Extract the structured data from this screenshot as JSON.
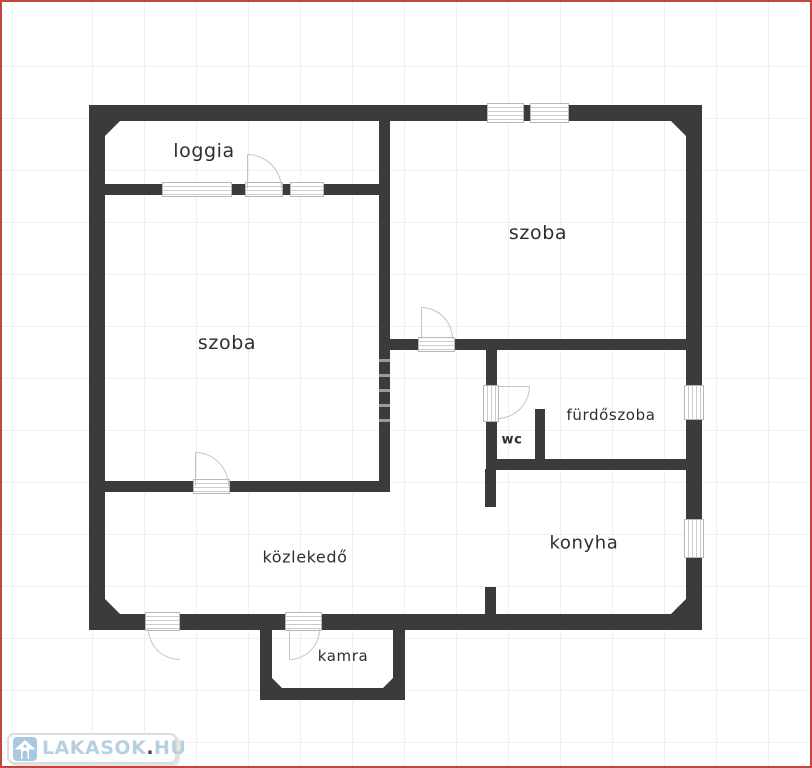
{
  "watermark": {
    "brand_left": "LAKASOK",
    "brand_dot": ".",
    "brand_right": "HU"
  },
  "rooms": [
    {
      "id": "loggia",
      "label": "loggia"
    },
    {
      "id": "szoba-left",
      "label": "szoba"
    },
    {
      "id": "szoba-right",
      "label": "szoba"
    },
    {
      "id": "furdoszoba",
      "label": "fürdőszoba"
    },
    {
      "id": "wc",
      "label": "wc"
    },
    {
      "id": "konyha",
      "label": "konyha"
    },
    {
      "id": "kozlekedo",
      "label": "közlekedő"
    },
    {
      "id": "kamra",
      "label": "kamra"
    }
  ],
  "colors": {
    "wall": "#3b3b3b",
    "frame_red": "#c2453e",
    "grid": "#f2f0ef",
    "glyph_gray": "#b7b7b7",
    "text": "#2e2e2e",
    "logo_blue": "#a9c8de"
  }
}
